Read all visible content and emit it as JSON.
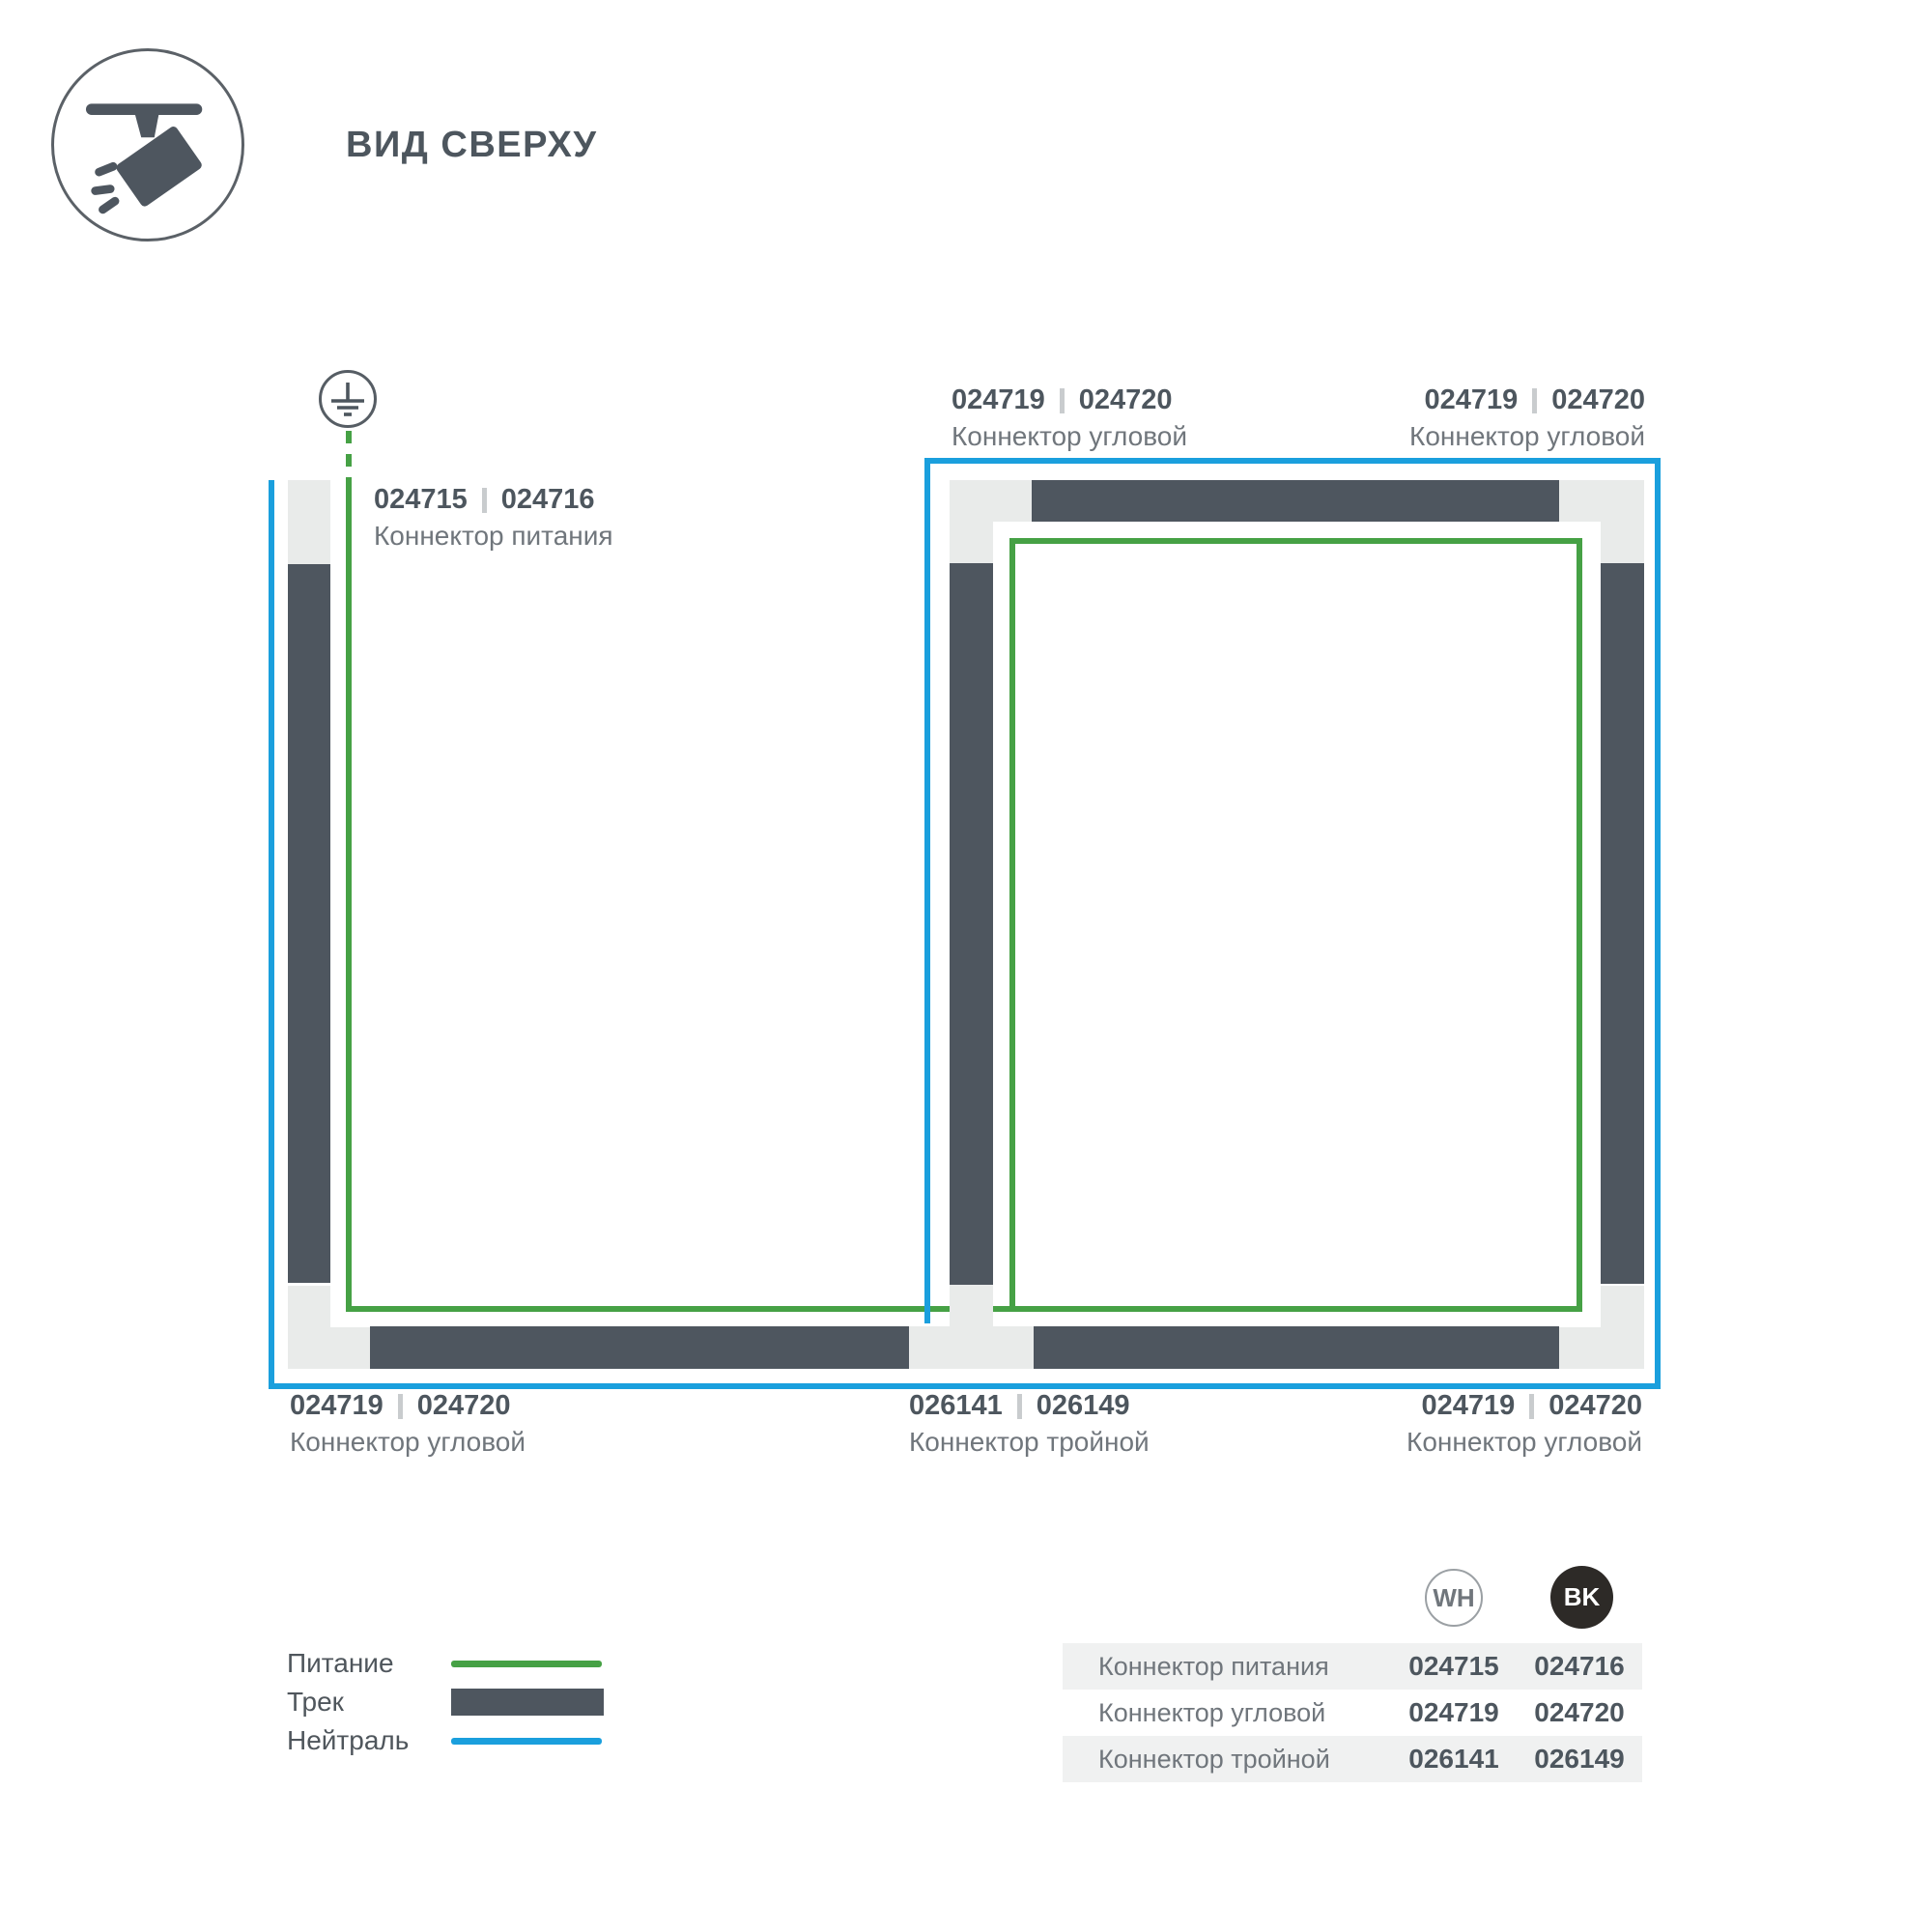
{
  "header": {
    "title": "ВИД СВЕРХУ",
    "icon": "track-spotlight-icon"
  },
  "colors": {
    "track": "#4e565f",
    "connector": "#e9ebea",
    "power_green": "#46a145",
    "neutral_blue": "#1a9fdd",
    "caption_gray": "#70767c",
    "numbers_gray": "#4d565e",
    "table_row_shade": "#f0f1f1",
    "bk_badge": "#2d2a27"
  },
  "diagram": {
    "ground_icon": "earth-ground-icon",
    "labels": {
      "power": {
        "code_wh": "024715",
        "code_bk": "024716",
        "caption": "Коннектор питания"
      },
      "corner_top_left": {
        "code_wh": "024719",
        "code_bk": "024720",
        "caption": "Коннектор угловой"
      },
      "corner_top_right": {
        "code_wh": "024719",
        "code_bk": "024720",
        "caption": "Коннектор угловой"
      },
      "corner_bottom_left": {
        "code_wh": "024719",
        "code_bk": "024720",
        "caption": "Коннектор угловой"
      },
      "triple": {
        "code_wh": "026141",
        "code_bk": "026149",
        "caption": "Коннектор тройной"
      },
      "corner_bottom_right": {
        "code_wh": "024719",
        "code_bk": "024720",
        "caption": "Коннектор угловой"
      }
    }
  },
  "legend": {
    "items": [
      {
        "label": "Питание",
        "swatch": "green-line"
      },
      {
        "label": "Трек",
        "swatch": "track-bar"
      },
      {
        "label": "Нейтраль",
        "swatch": "blue-line"
      }
    ]
  },
  "table": {
    "columns": [
      {
        "badge": "WH"
      },
      {
        "badge": "BK"
      }
    ],
    "rows": [
      {
        "name": "Коннектор питания",
        "wh": "024715",
        "bk": "024716"
      },
      {
        "name": "Коннектор угловой",
        "wh": "024719",
        "bk": "024720"
      },
      {
        "name": "Коннектор тройной",
        "wh": "026141",
        "bk": "026149"
      }
    ]
  }
}
